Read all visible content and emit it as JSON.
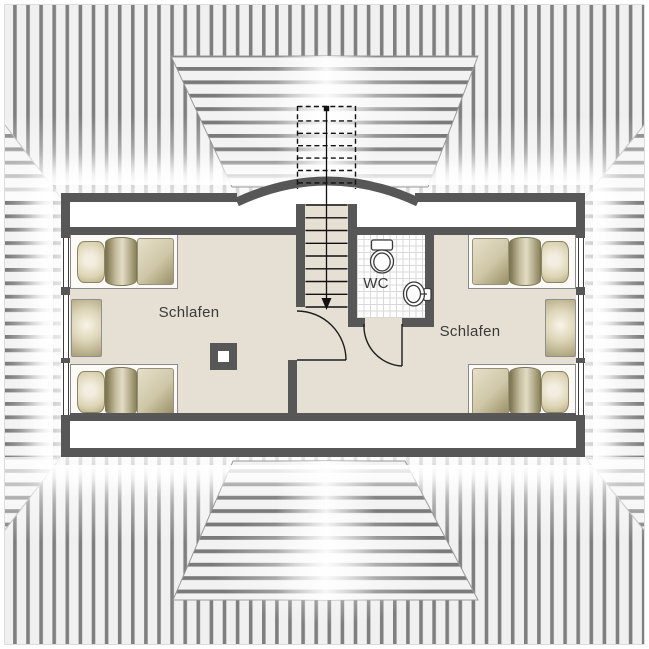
{
  "rooms": {
    "bedroom_left": {
      "label": "Schlafen"
    },
    "bedroom_right": {
      "label": "Schlafen"
    },
    "wc": {
      "label": "WC"
    }
  },
  "fixtures": {
    "stairs": "staircase-with-down-arrow",
    "toilet": "toilet-top-view",
    "sink": "washbasin-top-view",
    "chimney": "chimney-flue",
    "bed_count": 4,
    "dresser_count": 2,
    "window_count": 6,
    "door_count": 2
  },
  "colors": {
    "wall": "#575757",
    "floor": "#e5e0d3",
    "roof_bg": "#f0f0f0",
    "roof_stripe": "#7f7f7f",
    "bed_khaki": "#b4a981",
    "label_text": "#3a3a3a"
  }
}
